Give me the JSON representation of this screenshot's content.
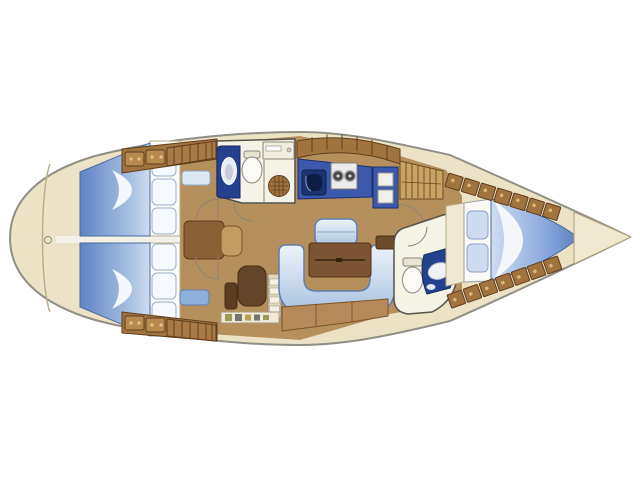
{
  "palette": {
    "background": "#ffffff",
    "hull_outline": "#8f8f86",
    "deck": "#ece3c6",
    "deck_shadow": "#b9ae90",
    "wood_floor": "#b6905c",
    "locker_wood": "#a1743f",
    "locker_wood_light": "#c9a265",
    "locker_line": "#5e3c1b",
    "wall": "#55524a",
    "fixture_white": "#f5f2e6",
    "navy_cabinet": "#3c58ad",
    "navy_dark": "#24418f",
    "sink_well": "#1d3372",
    "bed_blue": "#5f84c4",
    "bed_blue_light": "#cfdcef",
    "settee_blue": "#aac2e0",
    "settee_light": "#eef3fa",
    "upholstery_outline": "#5f7fae",
    "pillow_blue": "#ccdbf0",
    "table_brown": "#7b5433",
    "seat_dark_brown": "#63452a",
    "chart_table_brown": "#8a6134",
    "seat_tan": "#c29c62",
    "steps_cream": "#ded5bd",
    "berth_white": "#fbfaf6",
    "arc_line": "#8a8578"
  },
  "floorplan": {
    "type": "sailing-yacht-interior-layout",
    "orientation": "bow-right",
    "areas": [
      "stern-platform",
      "aft-cabin-port",
      "aft-cabin-starboard",
      "aft-head",
      "navigation-area",
      "companionway-steps",
      "galley",
      "hanging-locker",
      "salon",
      "forward-head",
      "forward-cabin",
      "anchor-locker"
    ]
  }
}
